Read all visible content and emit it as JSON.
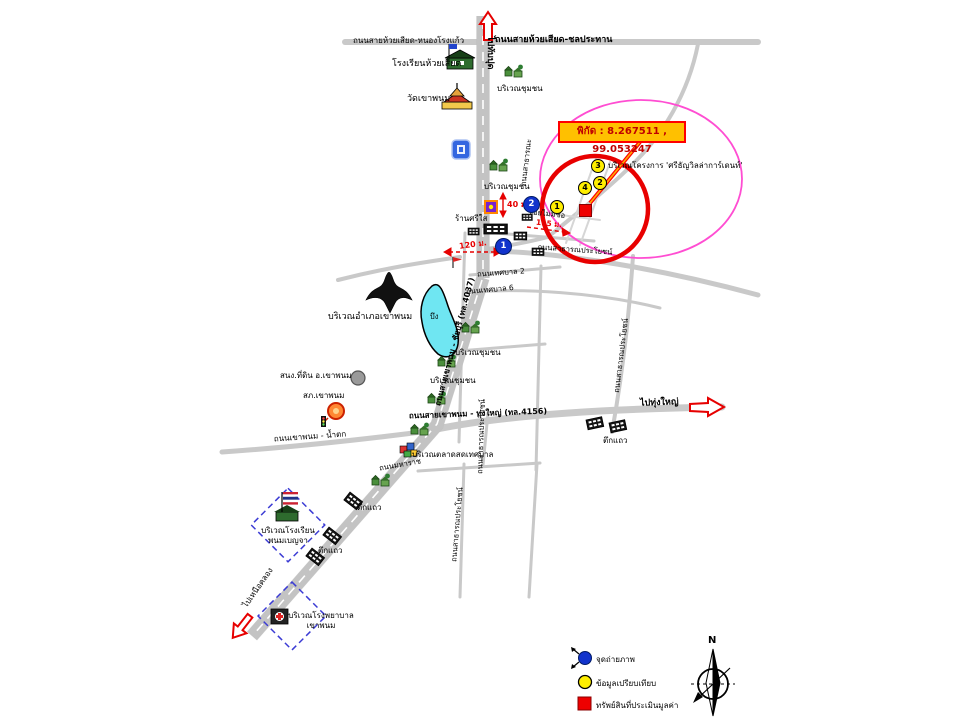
{
  "callout": {
    "coords_label": "พิกัด : 8.267511 , 99.053247"
  },
  "directions": {
    "north": "ไปทับปุด",
    "east": "ไปทุ่งใหญ่",
    "southwest": "ไปเหนือคลอง"
  },
  "roads": {
    "top_left": "ถนนสายห้วยเสียด-หนองโรงแก้ว",
    "top_right": "ถนนสายห้วยเสียด-ชลประทาน",
    "main_vertical": "ถนนสายเขาพนม - ชัยบุรี (ทล.4037)",
    "thungyai": "ถนนสายเขาพนม - ทุ่งใหญ่ (ทล.4156)",
    "namtok": "ถนนเขาพนม - น้ำตก",
    "thesaban2": "ถนนเทศบาล 2",
    "thesaban6": "ถนนเทศบาล 6",
    "maharat": "ถนนมหาราช",
    "satharana": "ถนนสาธารณะ",
    "public": "ถนนสาธารณประโยชน์",
    "soi": "ซอยไม่มีชื่อ"
  },
  "places": {
    "school_huai_siat": "โรงเรียนห้วยเสียด",
    "temple": "วัดเขาพนม",
    "community": "บริเวณชุมชน",
    "project": "บริเวณโครงการ 'ศรีธัญวิลล่าการ์เดนท์'",
    "shop": "ร้านศรีใส",
    "amphoe": "บริเวณอำเภอเขาพนม",
    "pond": "บึง",
    "land_office": "สนง.ที่ดิน อ.เขาพนม",
    "police": "สภ.เขาพนม",
    "market": "บริเวณตลาดสดเทศบาล",
    "shophouse": "ตึกแถว",
    "school_phanom": "บริเวณโรงเรียน\nพนมเบญจา",
    "hospital": "บริเวณโรงพยาบาล\nเขาพนม"
  },
  "measurements": {
    "m40": "40 ม.",
    "m115": "115 ม.",
    "m120": "120 ม."
  },
  "markers": {
    "photo": [
      "1",
      "2"
    ],
    "comparables": [
      "1",
      "2",
      "3",
      "4"
    ]
  },
  "legend": {
    "items": [
      {
        "icon": "photo-point",
        "label": "จุดถ่ายภาพ"
      },
      {
        "icon": "comparable",
        "label": "ข้อมูลเปรียบเทียบ"
      },
      {
        "icon": "subject-property",
        "label": "ทรัพย์สินที่ประเมินมูลค่า"
      }
    ]
  },
  "compass": {
    "north": "N"
  },
  "colors": {
    "highlight_circle": "#e80000",
    "area_ellipse": "#ff4dd2",
    "callout_bg": "#ffc000",
    "photo_point": "#1133cc",
    "comparable": "#ffee00",
    "subject": "#ee0000",
    "pond": "#6fe6f2",
    "road": "#c9c9c9"
  }
}
